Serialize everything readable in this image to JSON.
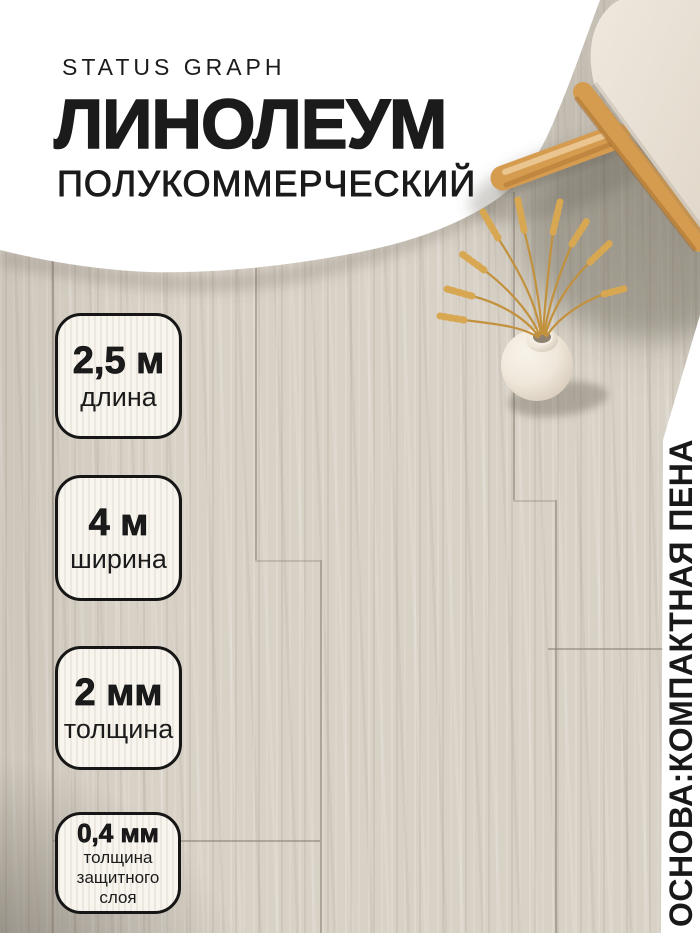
{
  "product": {
    "brand": "STATUS GRAPH",
    "title": "ЛИНОЛЕУМ",
    "subtitle": "ПОЛУКОММЕРЧЕСКИЙ"
  },
  "badges": [
    {
      "value": "2,5 м",
      "label": "длина"
    },
    {
      "value": "4 м",
      "label": "ширина"
    },
    {
      "value": "2 мм",
      "label": "толщина"
    },
    {
      "value": "0,4 мм",
      "label": "толщина\nзащитного\nслоя"
    }
  ],
  "side_note": "ОСНОВА:КОМПАКТНАЯ ПЕНА",
  "colors": {
    "text": "#1b1b1b",
    "backdrop_white": "#ffffff",
    "floor_base": "#d8d1c6",
    "badge_background": "#f8f5ef",
    "badge_border": "#161616",
    "wood_accent": "#d59c50",
    "wheat": "#d8a751",
    "cushion": "#e9e1d6"
  },
  "scene": {
    "elements": [
      "wood-plank-floor",
      "white-curved-backdrop",
      "stool-with-cushion",
      "round-vase-with-dried-wheat",
      "white-side-banner"
    ]
  }
}
